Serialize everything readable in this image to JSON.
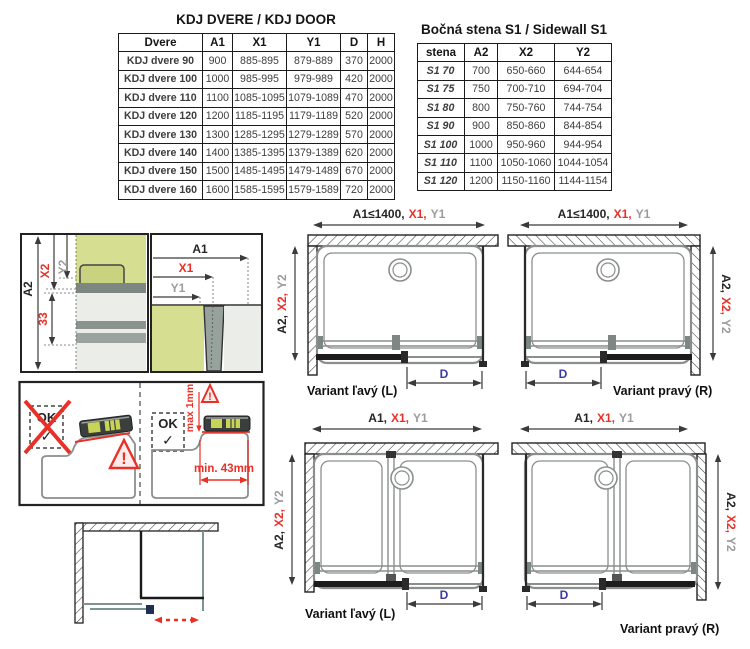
{
  "door_table": {
    "title": "KDJ DVERE / KDJ DOOR",
    "headers": [
      "Dvere",
      "A1",
      "X1",
      "Y1",
      "D",
      "H"
    ],
    "rows": [
      {
        "name": "KDJ dvere 90",
        "a1": "900",
        "x1": "885-895",
        "y1": "879-889",
        "d": "370",
        "h": "2000"
      },
      {
        "name": "KDJ dvere 100",
        "a1": "1000",
        "x1": "985-995",
        "y1": "979-989",
        "d": "420",
        "h": "2000"
      },
      {
        "name": "KDJ dvere 110",
        "a1": "1100",
        "x1": "1085-1095",
        "y1": "1079-1089",
        "d": "470",
        "h": "2000"
      },
      {
        "name": "KDJ dvere 120",
        "a1": "1200",
        "x1": "1185-1195",
        "y1": "1179-1189",
        "d": "520",
        "h": "2000"
      },
      {
        "name": "KDJ dvere 130",
        "a1": "1300",
        "x1": "1285-1295",
        "y1": "1279-1289",
        "d": "570",
        "h": "2000"
      },
      {
        "name": "KDJ dvere 140",
        "a1": "1400",
        "x1": "1385-1395",
        "y1": "1379-1389",
        "d": "620",
        "h": "2000"
      },
      {
        "name": "KDJ dvere 150",
        "a1": "1500",
        "x1": "1485-1495",
        "y1": "1479-1489",
        "d": "670",
        "h": "2000"
      },
      {
        "name": "KDJ dvere 160",
        "a1": "1600",
        "x1": "1585-1595",
        "y1": "1579-1589",
        "d": "720",
        "h": "2000"
      }
    ]
  },
  "sidewall_table": {
    "title": "Bočná stena S1 / Sidewall S1",
    "headers": [
      "stena",
      "A2",
      "X2",
      "Y2"
    ],
    "rows": [
      {
        "name": "S1 70",
        "a2": "700",
        "x2": "650-660",
        "y2": "644-654"
      },
      {
        "name": "S1 75",
        "a2": "750",
        "x2": "700-710",
        "y2": "694-704"
      },
      {
        "name": "S1 80",
        "a2": "800",
        "x2": "750-760",
        "y2": "744-754"
      },
      {
        "name": "S1 90",
        "a2": "900",
        "x2": "850-860",
        "y2": "844-854"
      },
      {
        "name": "S1 100",
        "a2": "1000",
        "x2": "950-960",
        "y2": "944-954"
      },
      {
        "name": "S1 110",
        "a2": "1100",
        "x2": "1050-1060",
        "y2": "1044-1054"
      },
      {
        "name": "S1 120",
        "a2": "1200",
        "x2": "1150-1160",
        "y2": "1144-1154"
      }
    ]
  },
  "dims": {
    "a1_limited": "A1≤1400,",
    "a1": "A1,",
    "x1": "X1,",
    "y1": "Y1",
    "a2": "A2,",
    "x2": "X2,",
    "y2": "Y2",
    "d": "D"
  },
  "cross": {
    "a1": "A1",
    "x1": "X1",
    "y1": "Y1",
    "a2": "A2",
    "x2": "X2",
    "y2": "Y2",
    "d33": "33"
  },
  "install": {
    "ok": "OK",
    "check": "✓",
    "excl": "!",
    "max1": "max 1mm",
    "min43": "min. 43mm"
  },
  "variants": {
    "left_label": "Variant ľavý (L)",
    "right_label": "Variant pravý (R)"
  },
  "colors": {
    "red": "#e73128",
    "gray": "#9c9c9c",
    "blue": "#3c3c9e",
    "green": "#d6de92",
    "light_gray": "#eaede8",
    "profile_gray": "#8a938f",
    "teal": "#7e9493"
  }
}
